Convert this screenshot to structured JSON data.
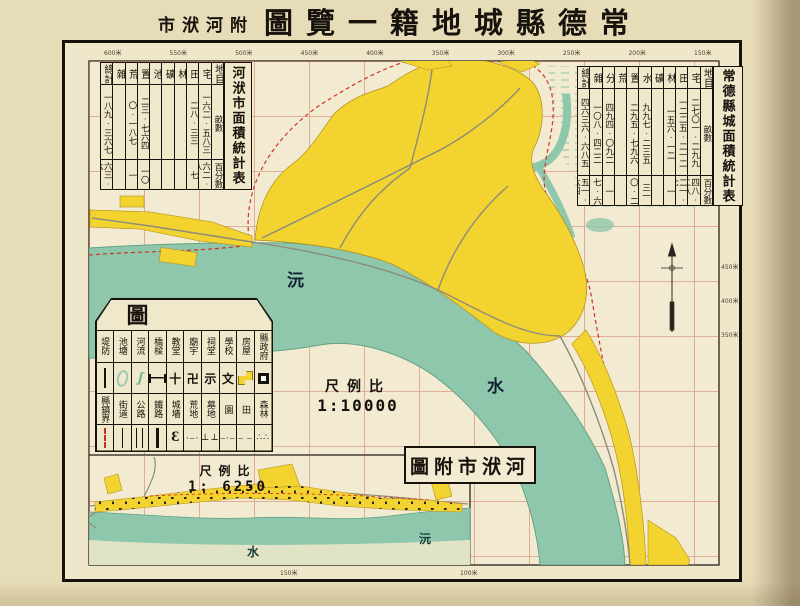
{
  "title": {
    "annex_display": "市洑河附",
    "main_display": "圖覽一籍地城縣德常",
    "reading_note_visible": false
  },
  "tables": {
    "hefu": {
      "title": "河洑市面積統計表",
      "columns": [
        {
          "h": "總計",
          "a": "一八九·三六七",
          "p": "六三·六"
        },
        {
          "h": "雜",
          "a": "",
          "p": ""
        },
        {
          "h": "荒",
          "a": "〇·一八七",
          "p": "一"
        },
        {
          "h": "置",
          "a": "二三·七六四",
          "p": "一〇"
        },
        {
          "h": "池",
          "a": "",
          "p": ""
        },
        {
          "h": "礦",
          "a": "",
          "p": ""
        },
        {
          "h": "林",
          "a": "",
          "p": ""
        },
        {
          "h": "田",
          "a": "二八·三三",
          "p": "七"
        },
        {
          "h": "宅",
          "a": "一六二·五八三",
          "p": "六二·八"
        },
        {
          "h": "地目",
          "a": "畝數",
          "p": "百分數"
        }
      ]
    },
    "changde": {
      "title": "常德縣城面積統計表",
      "columns": [
        {
          "h": "總計",
          "a": "四六三六·六八五",
          "p": "五一·六四"
        },
        {
          "h": "雜",
          "a": "一〇八·四二二",
          "p": "七·六"
        },
        {
          "h": "分",
          "a": "四九四·〇九二",
          "p": "一"
        },
        {
          "h": "荒",
          "a": "",
          "p": ""
        },
        {
          "h": "置",
          "a": "二九五·七九六",
          "p": "〇·二"
        },
        {
          "h": "水",
          "a": "九九七·二三五",
          "p": "三一"
        },
        {
          "h": "礦",
          "a": "",
          "p": ""
        },
        {
          "h": "林",
          "a": "一五六·一二",
          "p": "一"
        },
        {
          "h": "田",
          "a": "一二二五·二一二",
          "p": "二一·七"
        },
        {
          "h": "宅",
          "a": "二七〇一·二九九",
          "p": "四八·二八"
        },
        {
          "h": "地目",
          "a": "畝數",
          "p": "百分數"
        }
      ]
    }
  },
  "legend": {
    "title_display": "例　圖",
    "rows": [
      {
        "labels": [
          "堤防",
          "池塘",
          "河流",
          "橋樑",
          "教堂",
          "廟宇",
          "祠堂",
          "學校",
          "房屋",
          "縣政府"
        ],
        "syms": [
          {
            "c": "dike"
          },
          {
            "c": "pond"
          },
          {
            "c": "river",
            "g": "ʃ"
          },
          {
            "c": "bridge"
          },
          {
            "c": "glyph",
            "g": "十"
          },
          {
            "c": "glyph",
            "g": "卍"
          },
          {
            "c": "glyph",
            "g": "示"
          },
          {
            "c": "glyph",
            "g": "文"
          },
          {
            "c": "house"
          },
          {
            "c": "gov"
          }
        ]
      },
      {
        "labels": [
          "縣鎮界",
          "街道",
          "公路",
          "鐵路",
          "城墻",
          "荒地",
          "墓地",
          "園",
          "田",
          "森林"
        ],
        "syms": [
          {
            "c": "bound"
          },
          {
            "c": "street"
          },
          {
            "c": "road"
          },
          {
            "c": "rail"
          },
          {
            "c": "wall",
            "g": "Ɛ"
          },
          {
            "c": "dots",
            "g": "·–·"
          },
          {
            "c": "dots",
            "g": "⊥⊥"
          },
          {
            "c": "dots",
            "g": "–·–"
          },
          {
            "c": "dots",
            "g": "– –"
          },
          {
            "c": "dots",
            "g": "∴∴"
          }
        ]
      }
    ]
  },
  "scales": {
    "main": {
      "label_display": "尺例比",
      "ratio": "1:10000"
    },
    "inset": {
      "label_display": "尺例比",
      "ratio": "1: 6250"
    }
  },
  "inset": {
    "title_display": "圖附市洑河",
    "river_label_right": "沅",
    "river_label_left": "水"
  },
  "map_labels": {
    "main_river_char_upper": "沅",
    "main_river_char_lower": "水"
  },
  "border_ticks": {
    "top": [
      "600米",
      "550米",
      "500米",
      "450米",
      "400米",
      "350米",
      "300米",
      "250米",
      "200米",
      "150米"
    ],
    "right": [
      "450米",
      "400米",
      "350米"
    ],
    "bottom": [
      "150米",
      "100米"
    ]
  },
  "colors": {
    "paper": "#e7dcb8",
    "map_ground": "#f2ebd1",
    "river_green": "#8fc7ac",
    "urban_yellow": "#f2d330",
    "grid_red": "#c85948",
    "boundary_red": "#d03227",
    "frame_black": "#17120c"
  }
}
